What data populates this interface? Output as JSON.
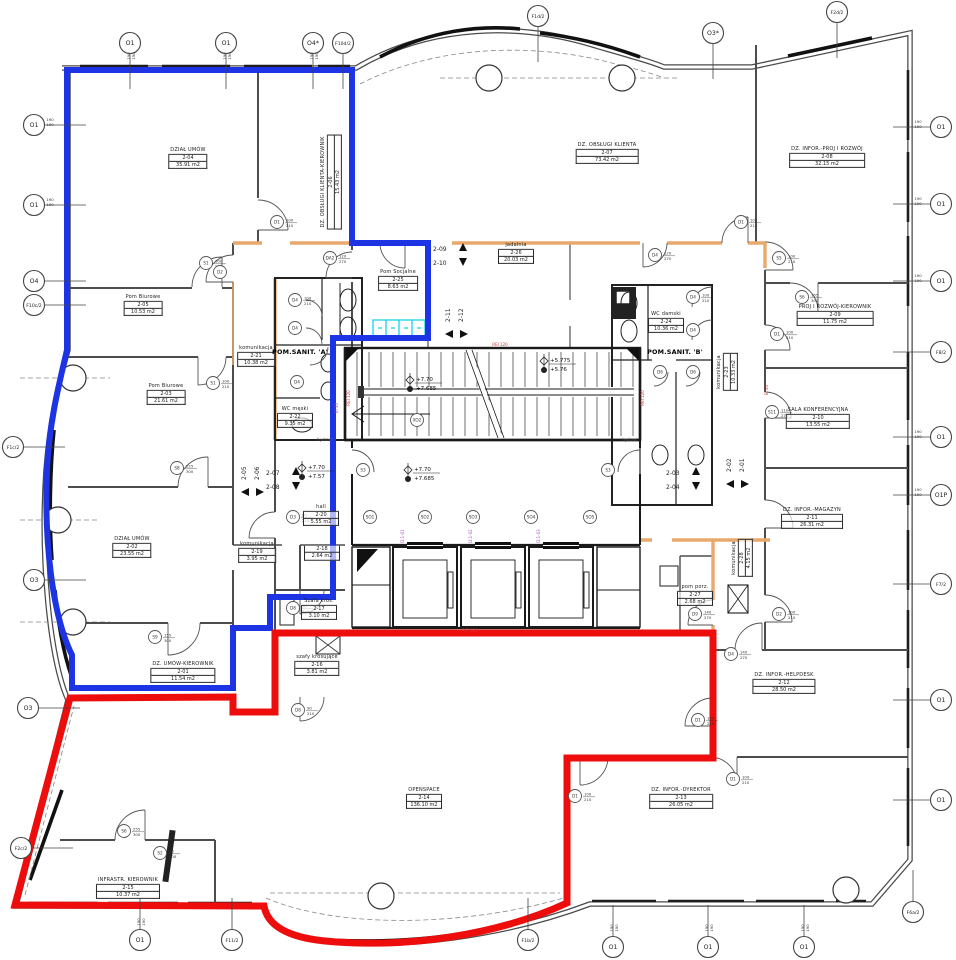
{
  "plan": {
    "zone_colors": {
      "blue": "#1c34e3",
      "red": "#ee0d0d",
      "partition_orange": "#e8a96b",
      "cyan_fixture": "#18d4e6"
    },
    "dim_value": "190",
    "rooms": [
      {
        "name": "DZIAŁ UMÓW",
        "number": "2-04",
        "area": "35.91 m2",
        "x": 188,
        "y": 158,
        "style": ""
      },
      {
        "name": "DZ. OBSŁUGI KLIENTA-KIEROWNIK",
        "number": "2-06",
        "area": "15.43 m2",
        "x": 331,
        "y": 182,
        "style": "v"
      },
      {
        "name": "DZ. OBSŁUGI KLIENTA",
        "number": "2-07",
        "area": "73.42 m2",
        "x": 607,
        "y": 153,
        "style": ""
      },
      {
        "name": "DZ. INFOR.-PROJ I ROZWÓJ",
        "number": "2-08",
        "area": "32.15 m2",
        "x": 827,
        "y": 157,
        "style": ""
      },
      {
        "name": "PROJ I ROZWÓJ-KIEROWNIK",
        "number": "2-09",
        "area": "11.75 m2",
        "x": 835,
        "y": 315,
        "style": ""
      },
      {
        "name": "SALA KONFERENCYJNA",
        "number": "2-10",
        "area": "13.55 m2",
        "x": 818,
        "y": 418,
        "style": ""
      },
      {
        "name": "DZ. INFOR.-MAGAZYN",
        "number": "2-11",
        "area": "26.31 m2",
        "x": 812,
        "y": 518,
        "style": ""
      },
      {
        "name": "DZ. INFOR.-HELPDESK",
        "number": "2-12",
        "area": "28.50 m2",
        "x": 784,
        "y": 683,
        "style": ""
      },
      {
        "name": "DZ. INFOR.-DYREKTOR",
        "number": "2-13",
        "area": "26.05 m2",
        "x": 681,
        "y": 798,
        "style": ""
      },
      {
        "name": "OPENSPACE",
        "number": "2-14",
        "area": "136.10 m2",
        "x": 424,
        "y": 798,
        "style": ""
      },
      {
        "name": "INFRASTR. KIEROWNIK",
        "number": "2-15",
        "area": "10.37 m2",
        "x": 128,
        "y": 888,
        "style": ""
      },
      {
        "name": "DZ. UMÓW-KIEROWNIK",
        "number": "2-01",
        "area": "11.54 m2",
        "x": 183,
        "y": 672,
        "style": ""
      },
      {
        "name": "DZIAŁ UMÓW",
        "number": "2-02",
        "area": "23.55 m2",
        "x": 132,
        "y": 547,
        "style": ""
      },
      {
        "name": "Pom Biurowe",
        "number": "2-05",
        "area": "10.53 m2",
        "x": 143,
        "y": 305,
        "style": ""
      },
      {
        "name": "Pom Biurowe",
        "number": "2-03",
        "area": "21.61 m2",
        "x": 166,
        "y": 394,
        "style": ""
      },
      {
        "name": "komunikacja",
        "number": "2-21",
        "area": "10.38 m2",
        "x": 256,
        "y": 356,
        "style": ""
      },
      {
        "name": "POM.SANIT. 'A'",
        "number": "",
        "area": "",
        "x": 300,
        "y": 352,
        "style": "b"
      },
      {
        "name": "WC męski",
        "number": "2-22",
        "area": "9.35 m2",
        "x": 295,
        "y": 417,
        "style": ""
      },
      {
        "name": "Pom Socjalne",
        "number": "2-25",
        "area": "8.63 m2",
        "x": 398,
        "y": 280,
        "style": ""
      },
      {
        "name": "jadalnia",
        "number": "2-26",
        "area": "20.03 m2",
        "x": 516,
        "y": 253,
        "style": ""
      },
      {
        "name": "WC damski",
        "number": "2-24",
        "area": "10.36 m2",
        "x": 666,
        "y": 322,
        "style": ""
      },
      {
        "name": "POM.SANIT. 'B'",
        "number": "",
        "area": "",
        "x": 675,
        "y": 352,
        "style": "b"
      },
      {
        "name": "komunikacja",
        "number": "2-23",
        "area": "10.33 m2",
        "x": 727,
        "y": 372,
        "style": "v"
      },
      {
        "name": "hall",
        "number": "2-20",
        "area": "5.55 m2",
        "x": 321,
        "y": 515,
        "style": ""
      },
      {
        "name": "komunikacja",
        "number": "2-19",
        "area": "3.95 m2",
        "x": 257,
        "y": 552,
        "style": ""
      },
      {
        "name": "",
        "number": "2-18",
        "area": "2.64 m2",
        "x": 322,
        "y": 553,
        "style": ""
      },
      {
        "name": "Szafa kros.",
        "number": "2-17",
        "area": "3.10 m2",
        "x": 319,
        "y": 609,
        "style": ""
      },
      {
        "name": "szafy krosujące",
        "number": "2-16",
        "area": "3.81 m2",
        "x": 317,
        "y": 665,
        "style": ""
      },
      {
        "name": "pom porz.",
        "number": "2-27",
        "area": "2.68 m2",
        "x": 695,
        "y": 595,
        "style": ""
      },
      {
        "name": "komunikacja",
        "number": "2-28",
        "area": "4.15 m2",
        "x": 742,
        "y": 558,
        "style": "v"
      }
    ],
    "grid_markers": [
      {
        "label": "O1",
        "x": 130,
        "y": 43,
        "side": "top"
      },
      {
        "label": "O1",
        "x": 226,
        "y": 43,
        "side": "top"
      },
      {
        "label": "O4*",
        "x": 313,
        "y": 43,
        "side": "top"
      },
      {
        "label": "F10d/2",
        "x": 343,
        "y": 43,
        "side": "top"
      },
      {
        "label": "F1d/2",
        "x": 538,
        "y": 16,
        "side": "top"
      },
      {
        "label": "O3*",
        "x": 713,
        "y": 33,
        "side": "top"
      },
      {
        "label": "F2d/2",
        "x": 837,
        "y": 12,
        "side": "top"
      },
      {
        "label": "O1",
        "x": 34,
        "y": 125,
        "side": "left"
      },
      {
        "label": "O1",
        "x": 34,
        "y": 205,
        "side": "left"
      },
      {
        "label": "O4",
        "x": 34,
        "y": 281,
        "side": "left"
      },
      {
        "label": "F10c/2",
        "x": 34,
        "y": 305,
        "side": "left"
      },
      {
        "label": "F1c/2",
        "x": 13,
        "y": 447,
        "side": "left"
      },
      {
        "label": "O3",
        "x": 34,
        "y": 580,
        "side": "left"
      },
      {
        "label": "O3",
        "x": 28,
        "y": 708,
        "side": "left"
      },
      {
        "label": "F2c/2",
        "x": 21,
        "y": 848,
        "side": "left"
      },
      {
        "label": "O1",
        "x": 941,
        "y": 127,
        "side": "right"
      },
      {
        "label": "O1",
        "x": 941,
        "y": 204,
        "side": "right"
      },
      {
        "label": "O1",
        "x": 941,
        "y": 281,
        "side": "right"
      },
      {
        "label": "F8/2",
        "x": 941,
        "y": 352,
        "side": "right"
      },
      {
        "label": "O1",
        "x": 941,
        "y": 437,
        "side": "right"
      },
      {
        "label": "O1P",
        "x": 941,
        "y": 495,
        "side": "right"
      },
      {
        "label": "F7/2",
        "x": 941,
        "y": 584,
        "side": "right"
      },
      {
        "label": "O1",
        "x": 941,
        "y": 700,
        "side": "right"
      },
      {
        "label": "O1",
        "x": 941,
        "y": 800,
        "side": "right"
      },
      {
        "label": "O1",
        "x": 140,
        "y": 940,
        "side": "bottom"
      },
      {
        "label": "F11/2",
        "x": 232,
        "y": 940,
        "side": "bottom"
      },
      {
        "label": "F1b/2",
        "x": 528,
        "y": 940,
        "side": "bottom"
      },
      {
        "label": "O1",
        "x": 613,
        "y": 947,
        "side": "bottom"
      },
      {
        "label": "O1",
        "x": 708,
        "y": 947,
        "side": "bottom"
      },
      {
        "label": "O1",
        "x": 804,
        "y": 947,
        "side": "bottom"
      },
      {
        "label": "F6a/2",
        "x": 913,
        "y": 912,
        "side": "bottom"
      }
    ],
    "door_tags": [
      {
        "label": "S1",
        "x": 206,
        "y": 263,
        "dim": "100/210"
      },
      {
        "label": "D1",
        "x": 277,
        "y": 222,
        "dim": "100/210"
      },
      {
        "label": "DA2",
        "x": 330,
        "y": 258,
        "dim": "120/270"
      },
      {
        "label": "S1",
        "x": 213,
        "y": 383,
        "dim": "100/210"
      },
      {
        "label": "D4",
        "x": 295,
        "y": 300,
        "dim": "100/210"
      },
      {
        "label": "D4",
        "x": 295,
        "y": 328,
        "dim": ""
      },
      {
        "label": "D4",
        "x": 297,
        "y": 382,
        "dim": ""
      },
      {
        "label": "D4",
        "x": 655,
        "y": 255,
        "dim": "120/270"
      },
      {
        "label": "D1",
        "x": 741,
        "y": 222,
        "dim": "100/210"
      },
      {
        "label": "S5",
        "x": 779,
        "y": 258,
        "dim": "100/210"
      },
      {
        "label": "D4",
        "x": 693,
        "y": 297,
        "dim": "100/210"
      },
      {
        "label": "S6",
        "x": 802,
        "y": 297,
        "dim": "155/300"
      },
      {
        "label": "D4",
        "x": 693,
        "y": 330,
        "dim": ""
      },
      {
        "label": "D6",
        "x": 660,
        "y": 372,
        "dim": ""
      },
      {
        "label": "D6",
        "x": 693,
        "y": 372,
        "dim": ""
      },
      {
        "label": "D1",
        "x": 777,
        "y": 334,
        "dim": "100/210"
      },
      {
        "label": "S11",
        "x": 772,
        "y": 412,
        "dim": "110/270"
      },
      {
        "label": "S8",
        "x": 177,
        "y": 468,
        "dim": "225/300"
      },
      {
        "label": "S3",
        "x": 363,
        "y": 470,
        "dim": ""
      },
      {
        "label": "S3",
        "x": 608,
        "y": 470,
        "dim": ""
      },
      {
        "label": "D3",
        "x": 293,
        "y": 517,
        "dim": "90/210"
      },
      {
        "label": "S9",
        "x": 155,
        "y": 637,
        "dim": "155/300"
      },
      {
        "label": "D8",
        "x": 293,
        "y": 608,
        "dim": "90/210"
      },
      {
        "label": "D8",
        "x": 298,
        "y": 710,
        "dim": "90/210"
      },
      {
        "label": "D9",
        "x": 695,
        "y": 614,
        "dim": "140/270"
      },
      {
        "label": "D2",
        "x": 779,
        "y": 614,
        "dim": "100/210"
      },
      {
        "label": "D4",
        "x": 731,
        "y": 654,
        "dim": "140/270"
      },
      {
        "label": "D1",
        "x": 698,
        "y": 720,
        "dim": "100/210"
      },
      {
        "label": "D1",
        "x": 575,
        "y": 796,
        "dim": "100/210"
      },
      {
        "label": "D1",
        "x": 733,
        "y": 779,
        "dim": "100/210"
      },
      {
        "label": "S6",
        "x": 124,
        "y": 831,
        "dim": "255/300"
      },
      {
        "label": "S2",
        "x": 160,
        "y": 853,
        "dim": "90/300"
      },
      {
        "label": "D2",
        "x": 220,
        "y": 272,
        "dim": ""
      },
      {
        "label": "SO1",
        "x": 370,
        "y": 517,
        "dim": ""
      },
      {
        "label": "SO2",
        "x": 425,
        "y": 517,
        "dim": ""
      },
      {
        "label": "SO3",
        "x": 473,
        "y": 517,
        "dim": ""
      },
      {
        "label": "SO4",
        "x": 531,
        "y": 517,
        "dim": ""
      },
      {
        "label": "SO5",
        "x": 590,
        "y": 517,
        "dim": ""
      },
      {
        "label": "XO2",
        "x": 417,
        "y": 420,
        "dim": ""
      }
    ],
    "direction_markers": [
      {
        "a": "2-09",
        "b": "2-10",
        "x": 433,
        "y": 246,
        "orient": "h"
      },
      {
        "a": "2-11",
        "b": "2-12",
        "x": 450,
        "y": 322,
        "orient": "v"
      },
      {
        "a": "2-05",
        "b": "2-06",
        "x": 246,
        "y": 480,
        "orient": "v"
      },
      {
        "a": "2-07",
        "b": "2-08",
        "x": 266,
        "y": 470,
        "orient": "h"
      },
      {
        "a": "2-03",
        "b": "2-04",
        "x": 666,
        "y": 470,
        "orient": "h"
      },
      {
        "a": "2-02",
        "b": "2-01",
        "x": 731,
        "y": 472,
        "orient": "v"
      }
    ],
    "level_markers": [
      {
        "top": "+7.70",
        "bottom": "+7.685",
        "x": 412,
        "y": 377
      },
      {
        "top": "+5.775",
        "bottom": "+5.76",
        "x": 546,
        "y": 358
      },
      {
        "top": "+7.70",
        "bottom": "+7.685",
        "x": 410,
        "y": 467
      },
      {
        "top": "+7.70",
        "bottom": "+7.57",
        "x": 304,
        "y": 465
      }
    ],
    "misc_texts": [
      {
        "text": "hydrant",
        "x": 325,
        "y": 441,
        "color": "#555555",
        "rot": false,
        "size": 4
      },
      {
        "text": "hydrant",
        "x": 630,
        "y": 441,
        "color": "#555555",
        "rot": false,
        "size": 4
      },
      {
        "text": "REI 120",
        "x": 500,
        "y": 346,
        "color": "#cc3333",
        "rot": false,
        "size": 4
      },
      {
        "text": "REI 120",
        "x": 350,
        "y": 398,
        "color": "#cc3333",
        "rot": true,
        "size": 4
      },
      {
        "text": "REI 120",
        "x": 644,
        "y": 398,
        "color": "#cc3333",
        "rot": true,
        "size": 4
      },
      {
        "text": "REI 120",
        "x": 470,
        "y": 632,
        "color": "#cc3333",
        "rot": false,
        "size": 4
      },
      {
        "text": "EI 30",
        "x": 768,
        "y": 390,
        "color": "#cc3333",
        "rot": true,
        "size": 4
      },
      {
        "text": "EI 30",
        "x": 338,
        "y": 408,
        "color": "#a44fc7",
        "rot": true,
        "size": 4
      },
      {
        "text": "D.1-01",
        "x": 404,
        "y": 536,
        "color": "#a44fc7",
        "rot": true,
        "size": 4
      },
      {
        "text": "D.1-02",
        "x": 472,
        "y": 536,
        "color": "#a44fc7",
        "rot": true,
        "size": 4
      },
      {
        "text": "D.1-03",
        "x": 540,
        "y": 536,
        "color": "#a44fc7",
        "rot": true,
        "size": 4
      }
    ],
    "window_dims": [
      {
        "x": 130,
        "y": 56,
        "rot": true
      },
      {
        "x": 226,
        "y": 56,
        "rot": true
      },
      {
        "x": 313,
        "y": 56,
        "rot": true
      },
      {
        "x": 50,
        "y": 121,
        "rot": false
      },
      {
        "x": 50,
        "y": 201,
        "rot": false
      },
      {
        "x": 918,
        "y": 123,
        "rot": false
      },
      {
        "x": 918,
        "y": 200,
        "rot": false
      },
      {
        "x": 918,
        "y": 277,
        "rot": false
      },
      {
        "x": 918,
        "y": 433,
        "rot": false
      },
      {
        "x": 918,
        "y": 491,
        "rot": false
      },
      {
        "x": 140,
        "y": 922,
        "rot": true
      },
      {
        "x": 613,
        "y": 928,
        "rot": true
      },
      {
        "x": 708,
        "y": 928,
        "rot": true
      },
      {
        "x": 804,
        "y": 928,
        "rot": true
      }
    ]
  }
}
